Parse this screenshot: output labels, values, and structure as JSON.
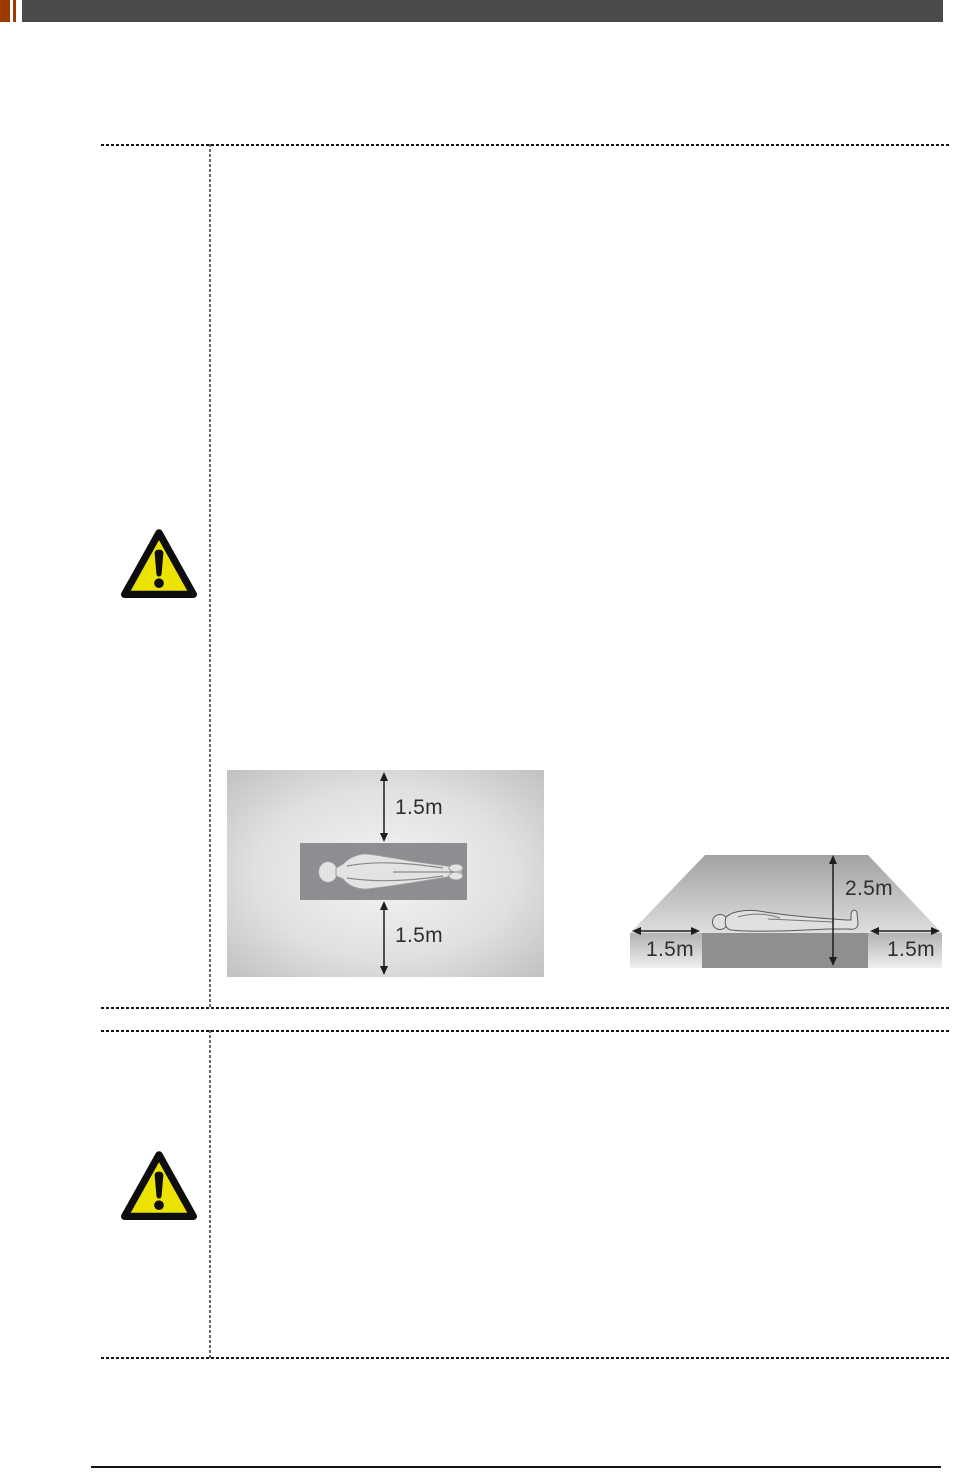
{
  "header": {
    "accent_color": "#9c3a00",
    "bar_color": "#4b4b4b"
  },
  "icons": {
    "warning": {
      "name": "warning-triangle",
      "fill_color": "#ece400",
      "stroke_color": "#0d0d0d"
    }
  },
  "diagrams": {
    "top_view": {
      "top_clearance": "1.5m",
      "bottom_clearance": "1.5m"
    },
    "side_view": {
      "left_clearance": "1.5m",
      "height_clearance": "2.5m",
      "right_clearance": "1.5m"
    }
  }
}
